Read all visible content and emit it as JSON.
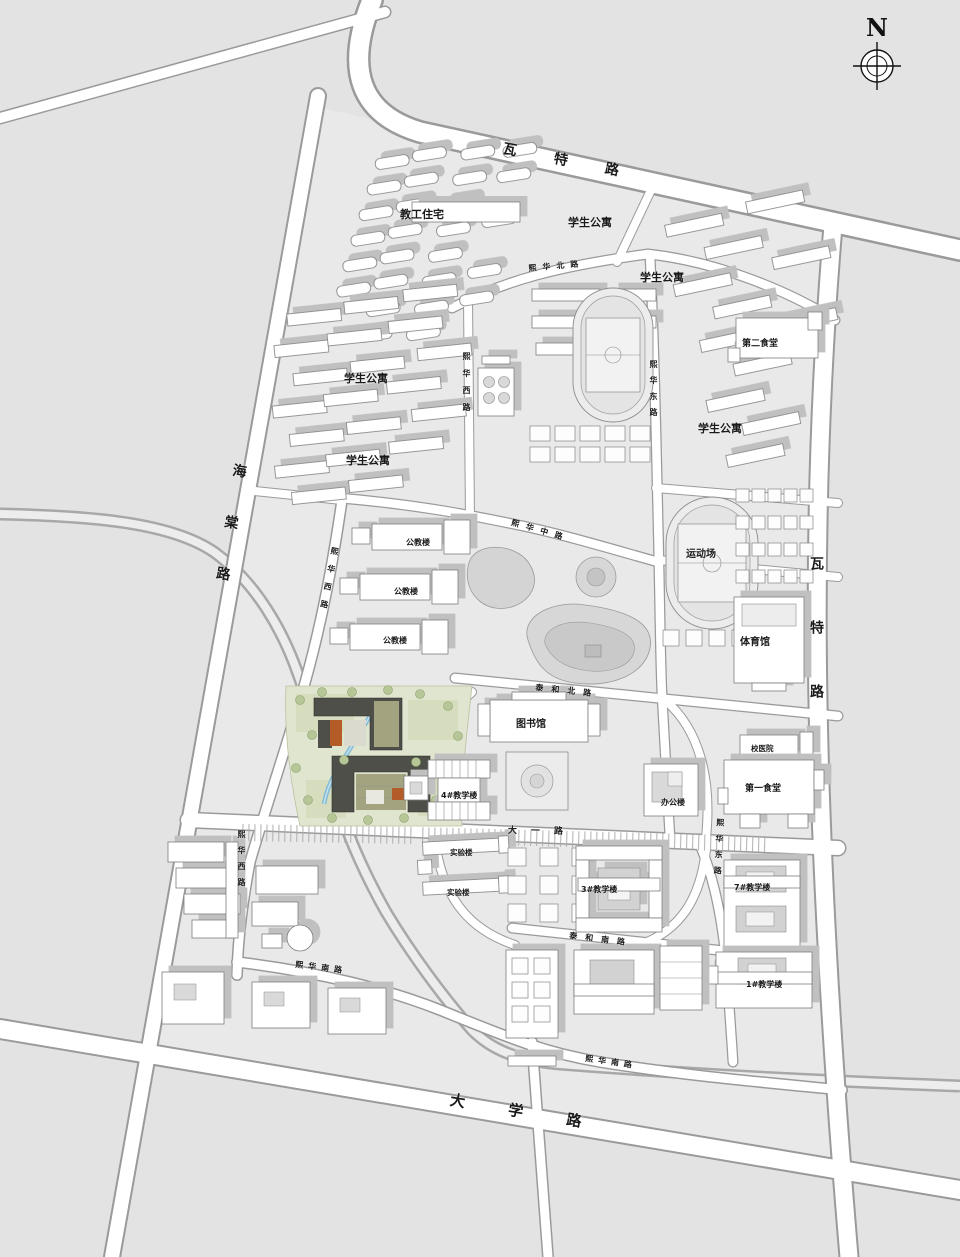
{
  "compass": {
    "label": "N"
  },
  "colors": {
    "background": "#e3e3e3",
    "road_fill": "#ffffff",
    "road_casing": "#9a9a9a",
    "building_shadow": "#c0c0c0",
    "site_green": "#e0e5d0",
    "site_building": "#4f4f49",
    "site_courtyard": "#a3a37f",
    "site_accent_orange": "#b35c28",
    "water": "#85bcd6"
  },
  "map": {
    "road_labels": [
      {
        "id": "watt-road-top",
        "text": "瓦特路",
        "x": 505,
        "y": 138,
        "s": 14,
        "r": 11,
        "ls": 38
      },
      {
        "id": "watt-road-east",
        "text": "瓦特路",
        "x": 806,
        "y": 556,
        "s": 14,
        "v": true,
        "ls": 50
      },
      {
        "id": "haitang-road",
        "text": "海棠路",
        "x": 230,
        "y": 462,
        "s": 14,
        "v": true,
        "ls": 38,
        "r": 9
      },
      {
        "id": "daxue-road",
        "text": "大学路",
        "x": 452,
        "y": 1089,
        "s": 15,
        "r": 9.5,
        "ls": 44
      },
      {
        "id": "xihua-north-road",
        "text": "熙华北路",
        "x": 528,
        "y": 263,
        "s": 8,
        "r": -5,
        "ls": 6
      },
      {
        "id": "xihua-middle-road",
        "text": "熙华中路",
        "x": 513,
        "y": 517,
        "s": 8,
        "r": 16,
        "ls": 7
      },
      {
        "id": "xihua-west-road-n",
        "text": "熙华西路",
        "x": 461,
        "y": 352,
        "s": 8,
        "v": true,
        "ls": 9
      },
      {
        "id": "xihua-west-road-mid",
        "text": "熙华西路",
        "x": 330,
        "y": 546,
        "s": 8,
        "v": true,
        "ls": 10,
        "r": 11
      },
      {
        "id": "xihua-west-road-s",
        "text": "熙华西路",
        "x": 236,
        "y": 830,
        "s": 8,
        "v": true,
        "ls": 8
      },
      {
        "id": "xihua-east-road-n",
        "text": "熙华东路",
        "x": 648,
        "y": 360,
        "s": 8,
        "v": true,
        "ls": 8
      },
      {
        "id": "xihua-east-road-s",
        "text": "熙华东路",
        "x": 715,
        "y": 818,
        "s": 8,
        "v": true,
        "ls": 8,
        "r": 3
      },
      {
        "id": "taihe-north-road",
        "text": "泰和北路",
        "x": 536,
        "y": 682,
        "s": 8,
        "r": 6,
        "ls": 8
      },
      {
        "id": "dayi-road",
        "text": "大一路",
        "x": 508,
        "y": 823,
        "s": 9,
        "r": 1,
        "ls": 14
      },
      {
        "id": "taihe-south-road",
        "text": "泰和南路",
        "x": 570,
        "y": 930,
        "s": 8,
        "r": 7,
        "ls": 8
      },
      {
        "id": "xihua-south-road-w",
        "text": "熙华南路",
        "x": 296,
        "y": 959,
        "s": 8,
        "r": 7,
        "ls": 5
      },
      {
        "id": "xihua-south-road-e",
        "text": "熙华南路",
        "x": 586,
        "y": 1053,
        "s": 8,
        "r": 8,
        "ls": 5
      }
    ],
    "building_labels": [
      {
        "id": "faculty-housing",
        "text": "教工住宅",
        "x": 400,
        "y": 206,
        "s": 11
      },
      {
        "id": "student-apts-n1",
        "text": "学生公寓",
        "x": 568,
        "y": 214,
        "s": 11
      },
      {
        "id": "student-apts-n2",
        "text": "学生公寓",
        "x": 640,
        "y": 269,
        "s": 11
      },
      {
        "id": "student-apts-w1",
        "text": "学生公寓",
        "x": 344,
        "y": 370,
        "s": 11
      },
      {
        "id": "student-apts-w2",
        "text": "学生公寓",
        "x": 346,
        "y": 452,
        "s": 11
      },
      {
        "id": "student-apts-e",
        "text": "学生公寓",
        "x": 698,
        "y": 420,
        "s": 11
      },
      {
        "id": "canteen-no2",
        "text": "第二食堂",
        "x": 742,
        "y": 336,
        "s": 9
      },
      {
        "id": "sports-field",
        "text": "运动场",
        "x": 686,
        "y": 545,
        "s": 10
      },
      {
        "id": "gymnasium",
        "text": "体育馆",
        "x": 740,
        "y": 633,
        "s": 10
      },
      {
        "id": "public-teaching-1",
        "text": "公教楼",
        "x": 406,
        "y": 537,
        "s": 8
      },
      {
        "id": "public-teaching-2",
        "text": "公教楼",
        "x": 394,
        "y": 586,
        "s": 8
      },
      {
        "id": "public-teaching-3",
        "text": "公教楼",
        "x": 383,
        "y": 635,
        "s": 8
      },
      {
        "id": "library",
        "text": "图书馆",
        "x": 516,
        "y": 715,
        "s": 10
      },
      {
        "id": "clinic",
        "text": "校医院",
        "x": 751,
        "y": 743,
        "s": 7.5
      },
      {
        "id": "canteen-no1",
        "text": "第一食堂",
        "x": 745,
        "y": 781,
        "s": 9
      },
      {
        "id": "office-building",
        "text": "办公楼",
        "x": 661,
        "y": 797,
        "s": 8
      },
      {
        "id": "teaching-no4",
        "text": "4#教学楼",
        "x": 441,
        "y": 790,
        "s": 8
      },
      {
        "id": "lab-building-1",
        "text": "实验楼",
        "x": 450,
        "y": 847,
        "s": 7.5
      },
      {
        "id": "lab-building-2",
        "text": "实验楼",
        "x": 447,
        "y": 887,
        "s": 7.5
      },
      {
        "id": "teaching-no3",
        "text": "3#教学楼",
        "x": 581,
        "y": 884,
        "s": 8
      },
      {
        "id": "teaching-no7",
        "text": "7#教学楼",
        "x": 734,
        "y": 882,
        "s": 8
      },
      {
        "id": "teaching-no1",
        "text": "1#教学楼",
        "x": 746,
        "y": 979,
        "s": 8
      }
    ]
  }
}
